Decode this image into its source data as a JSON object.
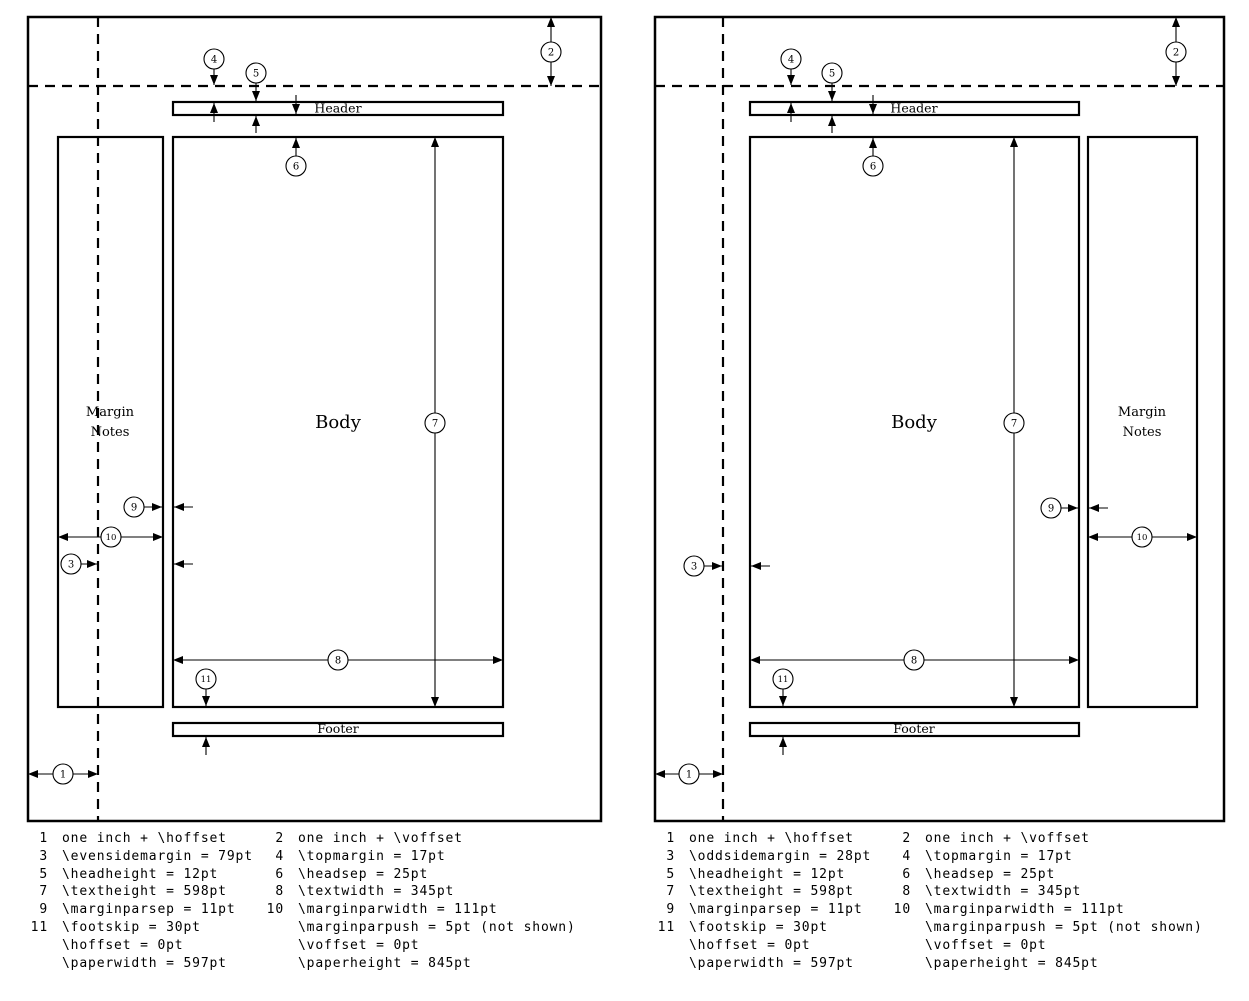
{
  "colors": {
    "ink": "#000000",
    "paper": "#ffffff"
  },
  "boxes": {
    "header": "Header",
    "body": "Body",
    "footer": "Footer",
    "margin_notes": [
      "Margin",
      "Notes"
    ]
  },
  "callout_numbers": [
    "1",
    "2",
    "3",
    "4",
    "5",
    "6",
    "7",
    "8",
    "9",
    "10",
    "11"
  ],
  "legend_even": {
    "rows": [
      [
        "1",
        "one inch + \\hoffset",
        "2",
        "one inch + \\voffset"
      ],
      [
        "3",
        "\\evensidemargin = 79pt",
        "4",
        "\\topmargin = 17pt"
      ],
      [
        "5",
        "\\headheight = 12pt",
        "6",
        "\\headsep = 25pt"
      ],
      [
        "7",
        "\\textheight = 598pt",
        "8",
        "\\textwidth = 345pt"
      ],
      [
        "9",
        "\\marginparsep = 11pt",
        "10",
        "\\marginparwidth = 111pt"
      ],
      [
        "11",
        "\\footskip = 30pt",
        "",
        "\\marginparpush = 5pt (not shown)"
      ],
      [
        "",
        "\\hoffset = 0pt",
        "",
        "\\voffset = 0pt"
      ],
      [
        "",
        "\\paperwidth = 597pt",
        "",
        "\\paperheight = 845pt"
      ]
    ]
  },
  "legend_odd": {
    "rows": [
      [
        "1",
        "one inch + \\hoffset",
        "2",
        "one inch + \\voffset"
      ],
      [
        "3",
        "\\oddsidemargin = 28pt",
        "4",
        "\\topmargin = 17pt"
      ],
      [
        "5",
        "\\headheight = 12pt",
        "6",
        "\\headsep = 25pt"
      ],
      [
        "7",
        "\\textheight = 598pt",
        "8",
        "\\textwidth = 345pt"
      ],
      [
        "9",
        "\\marginparsep = 11pt",
        "10",
        "\\marginparwidth = 111pt"
      ],
      [
        "11",
        "\\footskip = 30pt",
        "",
        "\\marginparpush = 5pt (not shown)"
      ],
      [
        "",
        "\\hoffset = 0pt",
        "",
        "\\voffset = 0pt"
      ],
      [
        "",
        "\\paperwidth = 597pt",
        "",
        "\\paperheight = 845pt"
      ]
    ]
  }
}
